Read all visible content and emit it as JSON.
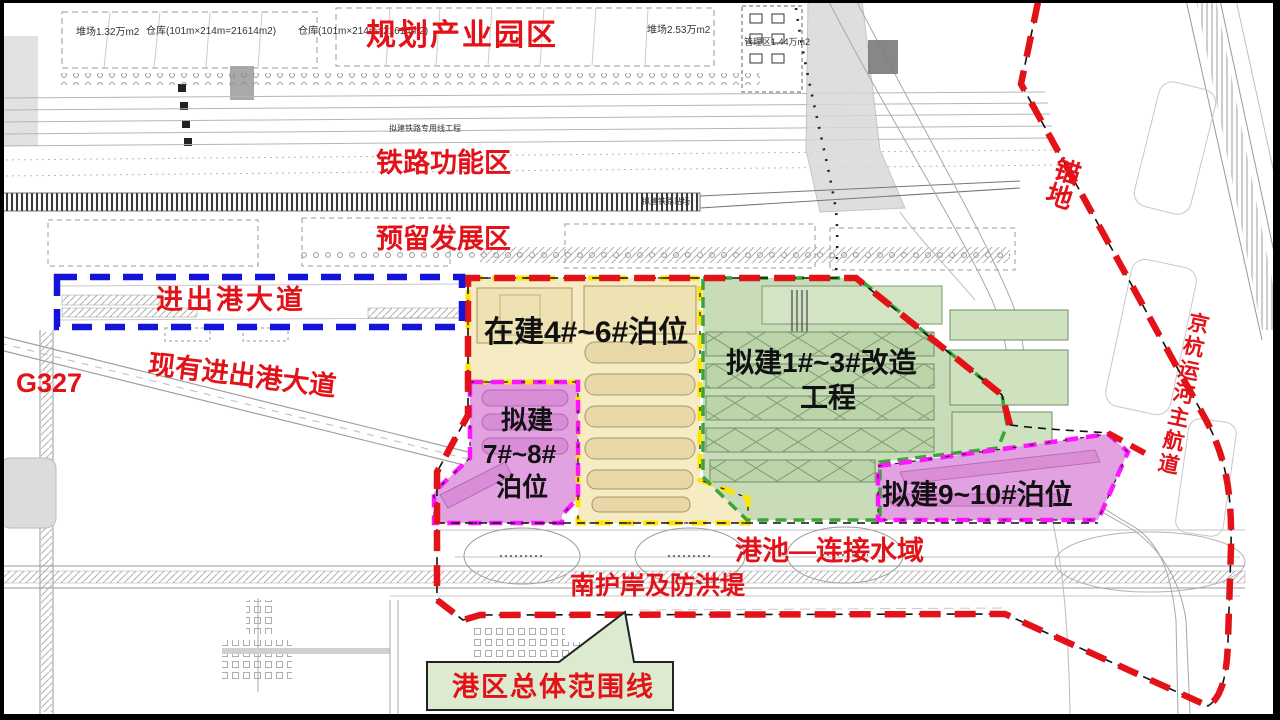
{
  "map": {
    "region_labels": {
      "planned_industrial_park": "规划产业园区",
      "railway_function_zone": "铁路功能区",
      "reserved_development_zone": "预留发展区",
      "port_access_avenue": "进出港大道",
      "existing_port_access_avenue": "现有进出港大道",
      "g327": "G327",
      "basin_connecting_waters": "港池—连接水域",
      "south_revetment_flood_dike": "南护岸及防洪堤",
      "anchorage": "锚地",
      "grand_canal_main_channel": "京杭运河主航道"
    },
    "zone_labels": {
      "berths_4_6": "在建4#~6#泊位",
      "berths_1_3_line1": "拟建1#~3#改造",
      "berths_1_3_line2": "工程",
      "berths_7_8_line1": "拟建",
      "berths_7_8_line2": "7#~8#",
      "berths_7_8_line3": "泊位",
      "berths_9_10": "拟建9~10#泊位"
    },
    "callout": {
      "port_area_boundary": "港区总体范围线"
    },
    "annotations": {
      "yard_left": "堆场1.32万m2",
      "warehouse_a": "仓库(101m×214m=21614m2)",
      "warehouse_b": "仓库(101m×214m=21614m2)",
      "yard_right": "堆场2.53万m2",
      "management_area": "管理区1.44万m2",
      "planned_railway_spur": "拟建铁路专用线工程",
      "planned_railway_yard": "拟建铁路站场"
    },
    "colors": {
      "boundary_red": "#e31219",
      "access_road_blue": "#1414d8",
      "zone_yellow_fill": "#f6ecc3",
      "zone_yellow_border": "#ffe400",
      "zone_green_fill": "#c8dcba",
      "zone_green_border": "#3aa437",
      "zone_pink_fill": "#e2a2e2",
      "zone_pink_border": "#ff14ff",
      "callout_fill": "#dcead0"
    }
  }
}
